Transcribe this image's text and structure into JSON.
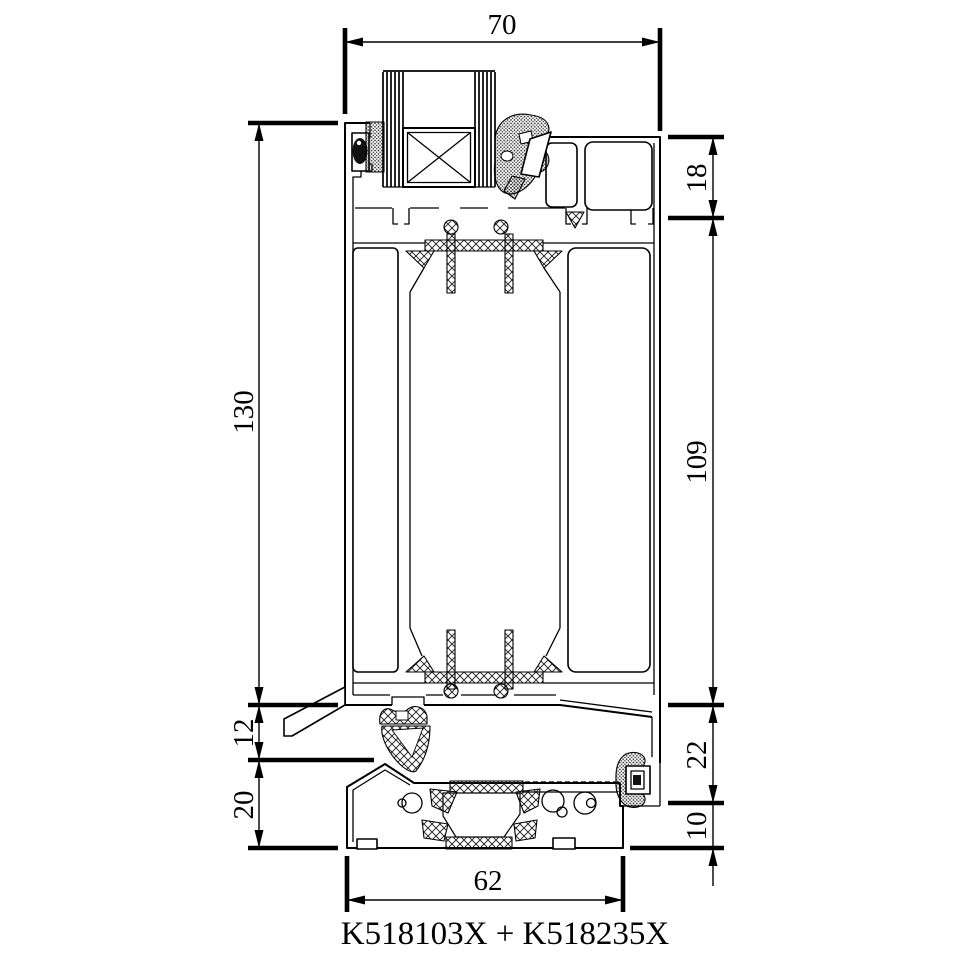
{
  "drawing": {
    "title": "K518103X + K518235X",
    "dims": {
      "glazing_width": "70",
      "overall_height": "130",
      "drip_height": "12",
      "base_height": "20",
      "top_chamber_height": "18",
      "mid_height": "109",
      "upstand_height": "22",
      "threshold_base_height": "10",
      "threshold_width": "62"
    },
    "colors": {
      "line": "#000000",
      "background": "#ffffff"
    }
  }
}
